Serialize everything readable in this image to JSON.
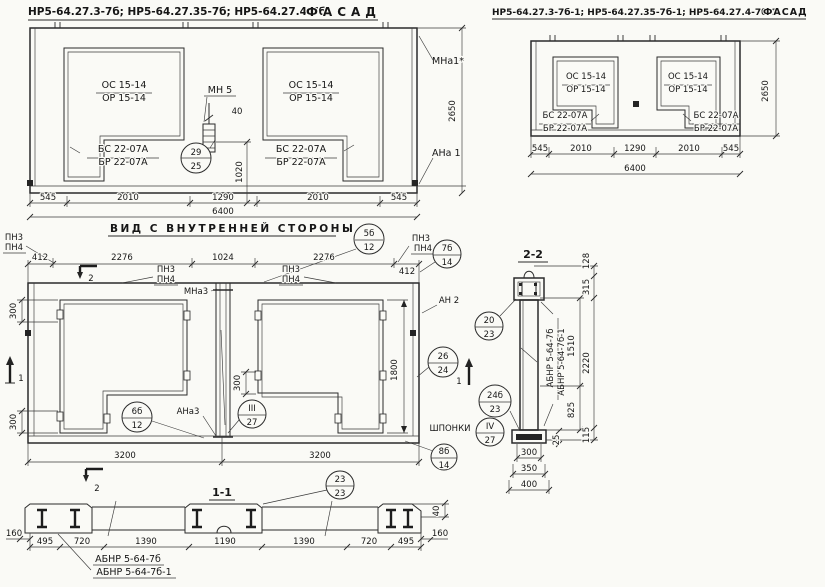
{
  "sheet": {
    "background": "#fafaf6",
    "ink": "#2b2b2b"
  },
  "marks": {
    "os": "ОС 15-14",
    "or": "ОР 15-14",
    "bs": "БС 22-07А",
    "br": "БР 22-07А",
    "mn5": "МН 5",
    "mna1": "МНа1*",
    "ana1": "АНа 1",
    "mna3": "МНа3",
    "ana3": "АНа3",
    "an2": "АН 2",
    "pn3": "ПН3",
    "pn4": "ПН4",
    "shponki": "ШПОНКИ",
    "abnr_a": "АБНР 5-64-7б",
    "abnr_b": "АБНР 5-64-7б-1"
  },
  "facade_left": {
    "title": "НР5-64.27.3-7б; НР5-64.27.35-7б; НР5-64.27.4-7б",
    "title_word": "ФАСАД",
    "callout": {
      "top": "29",
      "bottom": "25"
    },
    "dims": {
      "d40": "40",
      "d1020": "1020",
      "d2650": "2650",
      "b1": "545",
      "b2": "2010",
      "b3": "1290",
      "b4": "2010",
      "b5": "545",
      "total": "6400"
    }
  },
  "facade_right": {
    "title": "НР5-64.27.3-7б-1; НР5-64.27.35-7б-1; НР5-64.27.4-7б-1",
    "title_word": "ФАСАД",
    "dims": {
      "d2650": "2650",
      "b1": "545",
      "b2": "2010",
      "b3": "1290",
      "b4": "2010",
      "b5": "545",
      "total": "6400"
    }
  },
  "inner_view": {
    "title": "ВИД С ВНУТРЕННЕЙ СТОРОНЫ",
    "cut1": "1",
    "cut2": "2",
    "dims": {
      "t1": "412",
      "t2": "2276",
      "t3": "1024",
      "t4": "2276",
      "t5": "412",
      "d300": "300",
      "d1800": "1800",
      "b1": "3200",
      "b2": "3200"
    },
    "callouts": {
      "c5": {
        "top": "5б",
        "bottom": "12"
      },
      "c6": {
        "top": "6б",
        "bottom": "12"
      },
      "c7": {
        "top": "7б",
        "bottom": "14"
      },
      "c8": {
        "top": "8б",
        "bottom": "14"
      },
      "c3": {
        "top": "III",
        "bottom": "27"
      },
      "c4": {
        "top": "IV",
        "bottom": "27"
      },
      "c20": {
        "top": "20",
        "bottom": "23"
      },
      "c26": {
        "top": "26",
        "bottom": "24"
      },
      "c24": {
        "top": "24б",
        "bottom": "23"
      }
    }
  },
  "section_2_2": {
    "title": "2-2",
    "dims": {
      "d128": "128",
      "d315": "315",
      "d2220": "2220",
      "d115": "115",
      "d1510": "1510",
      "d825": "825",
      "d25": "25",
      "d300": "300",
      "d350": "350",
      "d400": "400"
    }
  },
  "section_1_1": {
    "title": "1-1",
    "callout": {
      "top": "23",
      "bottom": "23"
    },
    "dims": {
      "left160": "160",
      "right160": "160",
      "d40": "40",
      "b1": "495",
      "b2": "720",
      "b3": "1390",
      "b4": "1190",
      "b5": "1390",
      "b6": "720",
      "b7": "495"
    }
  }
}
